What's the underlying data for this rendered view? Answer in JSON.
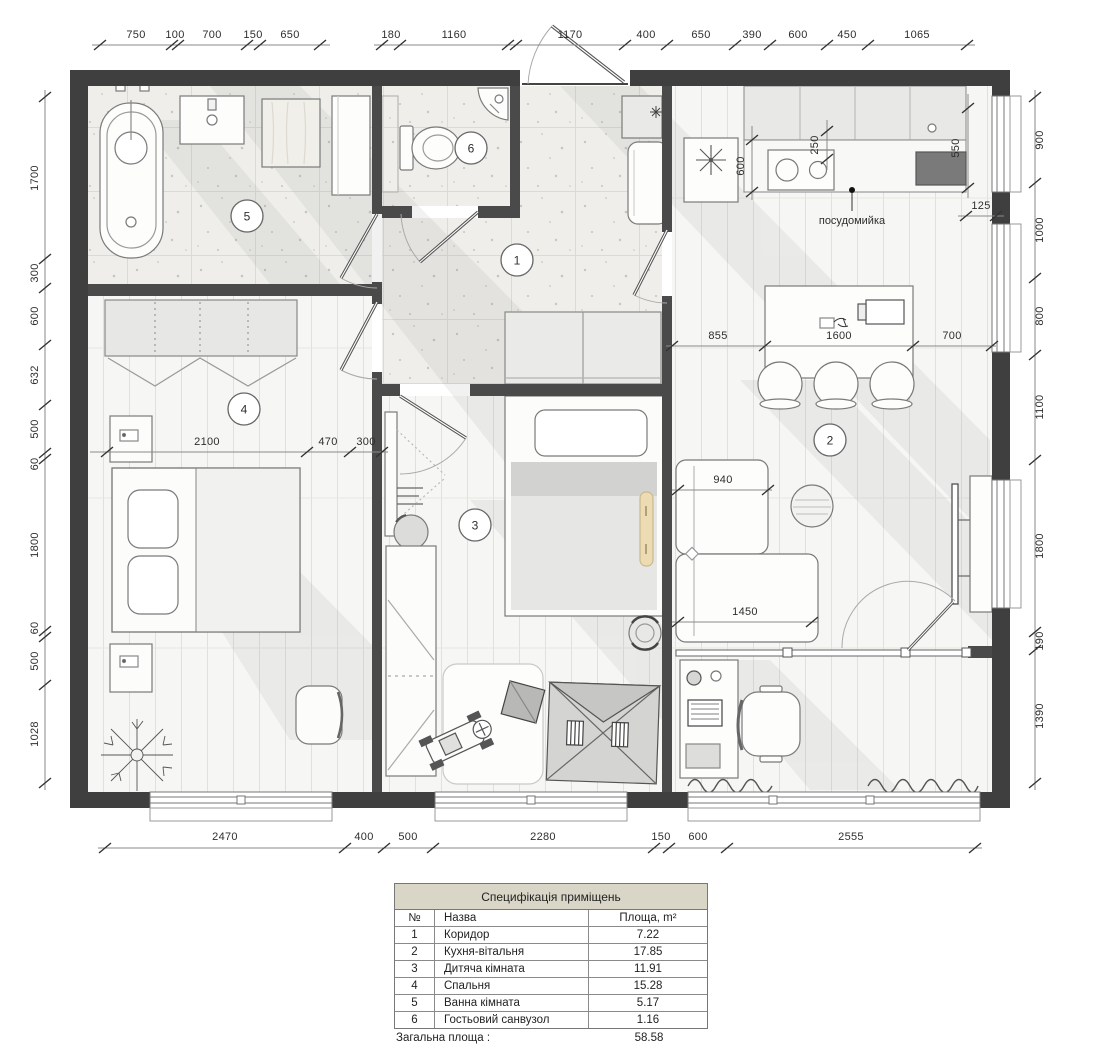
{
  "plan": {
    "rooms": [
      {
        "num": "1"
      },
      {
        "num": "2"
      },
      {
        "num": "3"
      },
      {
        "num": "4"
      },
      {
        "num": "5"
      },
      {
        "num": "6"
      }
    ],
    "labels": {
      "dishwasher": "посудомийка"
    },
    "dims": {
      "top": [
        "750",
        "100",
        "700",
        "150",
        "650",
        "180",
        "1160",
        "1170",
        "400",
        "650",
        "390",
        "600",
        "450",
        "1065"
      ],
      "left": [
        "1700",
        "300",
        "600",
        "632",
        "500",
        "60",
        "1800",
        "60",
        "500",
        "1028"
      ],
      "right": [
        "900",
        "1000",
        "800",
        "1100",
        "1800",
        "190",
        "1390"
      ],
      "bottom": [
        "2470",
        "400",
        "500",
        "2280",
        "150",
        "600",
        "2555"
      ],
      "inner": {
        "counter_depth": "600",
        "hood_offset": "250",
        "window_right": "550",
        "wall_gap": "125",
        "island_left": "855",
        "island_width": "1600",
        "island_right": "700",
        "sofa_depth": "940",
        "sofa_width": "1450",
        "bed_width": "2100",
        "gap_470": "470",
        "gap_300": "300"
      }
    }
  },
  "table": {
    "title": "Специфікація приміщень",
    "headers": {
      "num": "№",
      "name": "Назва",
      "area": "Площа, m²"
    },
    "rows": [
      {
        "num": "1",
        "name": "Коридор",
        "area": "7.22"
      },
      {
        "num": "2",
        "name": "Кухня-вітальня",
        "area": "17.85"
      },
      {
        "num": "3",
        "name": "Дитяча кімната",
        "area": "11.91"
      },
      {
        "num": "4",
        "name": "Спальня",
        "area": "15.28"
      },
      {
        "num": "5",
        "name": "Ванна кімната",
        "area": "5.17"
      },
      {
        "num": "6",
        "name": "Гостьовий санвузол",
        "area": "1.16"
      }
    ],
    "total_label": "Загальна площа :",
    "total_value": "58.58"
  }
}
